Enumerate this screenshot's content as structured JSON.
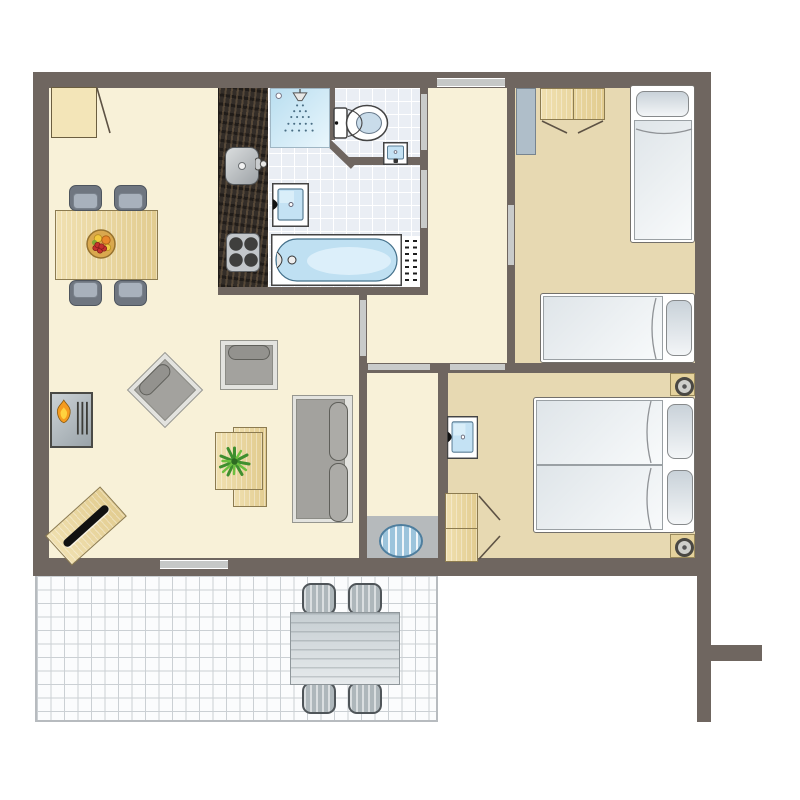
{
  "colors": {
    "wall": "#6F6660",
    "floorLiving": "#F8F1D8",
    "floorBedroom": "#E7D9B2",
    "floorBath": "#EAEEF4",
    "tileLine": "#FFFFFF",
    "floorTerrace": "#FBFCFD",
    "terraceLine": "#CBD0D4",
    "counter": "#332D28",
    "woodBorder": "#8C7B50",
    "doorBar": "#C9CBCA",
    "windowBar": "#C6C8C7",
    "grayA": "#A8B1BC",
    "grayB": "#6F7680",
    "sofaFrame": "#E3E3DF",
    "sofaSeat": "#A3A29E",
    "cushion": "#ACABA7",
    "fixtureBlue": "#C4E2F4",
    "flameOrange": "#F59B1E",
    "flameYellow": "#FFD23F",
    "plantGreen": "#3F8F2F",
    "matBlue": "#9CC4DC",
    "bedWhite": "#FFFFFF",
    "radiator": "#AFBEC9",
    "vestibule": "#B6BABC",
    "lampWood": "#E5D29C"
  },
  "shapes": [
    {
      "n": "living-room-floor",
      "c": "floor-living",
      "b": [
        49,
        88,
        646,
        472
      ]
    },
    {
      "n": "bedroom1-floor",
      "c": "floor-bed",
      "b": [
        515,
        88,
        180,
        277
      ]
    },
    {
      "n": "bedroom2-floor",
      "c": "floor-bed",
      "b": [
        448,
        373,
        247,
        187
      ]
    },
    {
      "n": "bathroom-floor",
      "c": "floor-bath",
      "b": [
        268,
        88,
        160,
        199
      ]
    },
    {
      "n": "kitchen-counter",
      "c": "counter",
      "b": [
        218,
        88,
        50,
        199
      ]
    },
    {
      "n": "vestibule-floor",
      "c": "vestibule",
      "b": [
        367,
        516,
        71,
        44
      ]
    },
    {
      "n": "terrace-floor",
      "c": "floor-terrace",
      "b": [
        35,
        574,
        403,
        148
      ]
    },
    {
      "n": "wall-top",
      "c": "wall",
      "b": [
        33,
        72,
        678,
        16
      ]
    },
    {
      "n": "wall-left",
      "c": "wall",
      "b": [
        33,
        72,
        16,
        504
      ]
    },
    {
      "n": "wall-right",
      "c": "wall",
      "b": [
        695,
        72,
        16,
        504
      ]
    },
    {
      "n": "wall-bottom",
      "c": "wall",
      "b": [
        33,
        558,
        678,
        18
      ]
    },
    {
      "n": "wall-right-extension",
      "c": "wall",
      "b": [
        697,
        576,
        14,
        146
      ]
    },
    {
      "n": "wall-garden-stub",
      "c": "wall",
      "b": [
        711,
        645,
        51,
        16
      ]
    },
    {
      "n": "wall-kitchenbath-south",
      "c": "wall",
      "b": [
        218,
        287,
        210,
        8
      ]
    },
    {
      "n": "wall-bathroom-east",
      "c": "wall",
      "b": [
        420,
        88,
        8,
        199
      ]
    },
    {
      "n": "wall-bedroom1-west",
      "c": "wall",
      "b": [
        507,
        88,
        8,
        277
      ]
    },
    {
      "n": "wall-middle",
      "c": "wall",
      "b": [
        359,
        363,
        352,
        10
      ]
    },
    {
      "n": "wall-living-hall",
      "c": "wall",
      "b": [
        359,
        294,
        8,
        69
      ]
    },
    {
      "n": "wall-corridor-west",
      "c": "wall",
      "b": [
        359,
        373,
        8,
        185
      ]
    },
    {
      "n": "wall-corridor-east",
      "c": "wall",
      "b": [
        438,
        373,
        10,
        185
      ]
    },
    {
      "n": "wall-toilet-west",
      "c": "wall",
      "b": [
        328,
        88,
        7,
        52
      ]
    },
    {
      "n": "wall-toilet-south",
      "c": "wall",
      "b": [
        348,
        157,
        72,
        8
      ]
    },
    {
      "n": "wall-toilet-diagonal",
      "c": "wall",
      "b": [
        327,
        136,
        40,
        7
      ],
      "r": 44,
      "o": "0 0"
    },
    {
      "n": "window-north",
      "c": "windowbar",
      "b": [
        437,
        78,
        68,
        9
      ]
    },
    {
      "n": "window-south",
      "c": "windowbar",
      "b": [
        160,
        560,
        68,
        9
      ]
    },
    {
      "n": "door-toilet",
      "c": "doorbar",
      "b": [
        421,
        94,
        6,
        56
      ]
    },
    {
      "n": "door-bathroom",
      "c": "doorbar",
      "b": [
        421,
        170,
        6,
        58
      ]
    },
    {
      "n": "door-bedroom1",
      "c": "doorbar",
      "b": [
        508,
        205,
        6,
        60
      ]
    },
    {
      "n": "door-corridor",
      "c": "doorbar",
      "b": [
        368,
        364,
        62,
        6
      ]
    },
    {
      "n": "door-bedroom2",
      "c": "doorbar",
      "b": [
        450,
        364,
        55,
        6
      ]
    },
    {
      "n": "door-living-hall",
      "c": "doorbar",
      "b": [
        360,
        300,
        6,
        56
      ]
    },
    {
      "n": "kitchen-sink",
      "c": "sink",
      "b": [
        225,
        147,
        34,
        38
      ]
    },
    {
      "n": "kitchen-faucet-icon",
      "c": "glyph",
      "b": [
        255,
        154,
        12,
        20
      ],
      "g": "kfaucet"
    },
    {
      "n": "kitchen-hob",
      "c": "hob",
      "b": [
        226,
        233,
        34,
        39
      ]
    },
    {
      "n": "shower",
      "c": "shower",
      "b": [
        270,
        88,
        60,
        60
      ],
      "g": "shower"
    },
    {
      "n": "toilet-icon",
      "c": "glyph",
      "b": [
        330,
        100,
        62,
        46
      ],
      "g": "toilet"
    },
    {
      "n": "hand-basin-icon",
      "c": "glyph",
      "b": [
        383,
        142,
        25,
        23
      ],
      "g": "handbasin"
    },
    {
      "n": "washbasin-icon",
      "c": "glyph",
      "b": [
        272,
        183,
        37,
        44
      ],
      "g": "basin"
    },
    {
      "n": "bathtub-icon",
      "c": "glyph",
      "b": [
        271,
        234,
        131,
        52
      ],
      "g": "tub"
    },
    {
      "n": "radiator-niche",
      "c": "white",
      "b": [
        402,
        236,
        18,
        51
      ]
    },
    {
      "n": "bathroom-radiator",
      "c": "radiator-v",
      "b": [
        404,
        240,
        15,
        45
      ]
    },
    {
      "n": "bedroom1-radiator",
      "c": "radiator-gray",
      "b": [
        516,
        88,
        20,
        67
      ]
    },
    {
      "n": "bedroom1-wardrobe",
      "c": "wood divider-v",
      "b": [
        540,
        88,
        65,
        32
      ]
    },
    {
      "n": "bedroom1-bed1-frame",
      "c": "bedframe",
      "b": [
        630,
        85,
        65,
        158
      ]
    },
    {
      "n": "bedroom1-bed1-mattress",
      "c": "mattress",
      "b": [
        634,
        120,
        58,
        120
      ]
    },
    {
      "n": "bedroom1-bed1-pillow",
      "c": "pillow",
      "b": [
        636,
        91,
        53,
        26
      ]
    },
    {
      "n": "bedroom1-bed2-frame",
      "c": "bedframe",
      "b": [
        540,
        293,
        155,
        70
      ]
    },
    {
      "n": "bedroom1-bed2-mattress",
      "c": "mattress",
      "b": [
        543,
        296,
        120,
        64
      ]
    },
    {
      "n": "bedroom1-bed2-pillow",
      "c": "pillow",
      "b": [
        666,
        300,
        26,
        56
      ]
    },
    {
      "n": "bedroom2-washbasin-icon",
      "c": "glyph",
      "b": [
        447,
        416,
        31,
        43
      ],
      "g": "basin"
    },
    {
      "n": "bedroom2-wardrobe",
      "c": "wood divider-h",
      "b": [
        445,
        493,
        33,
        69
      ]
    },
    {
      "n": "bedroom2-bed-frame",
      "c": "bedframe",
      "b": [
        533,
        397,
        162,
        136
      ]
    },
    {
      "n": "bedroom2-mattress-a",
      "c": "mattress",
      "b": [
        536,
        400,
        127,
        65
      ]
    },
    {
      "n": "bedroom2-mattress-b",
      "c": "mattress",
      "b": [
        536,
        465,
        127,
        65
      ]
    },
    {
      "n": "bedroom2-pillow-a",
      "c": "pillow",
      "b": [
        667,
        404,
        26,
        55
      ]
    },
    {
      "n": "bedroom2-pillow-b",
      "c": "pillow",
      "b": [
        667,
        470,
        26,
        55
      ]
    },
    {
      "n": "bedroom2-ceiling-spot-1",
      "c": "lamp",
      "b": [
        670,
        373,
        25,
        23
      ]
    },
    {
      "n": "bedroom2-ceiling-spot-2",
      "c": "lamp",
      "b": [
        670,
        534,
        25,
        24
      ]
    },
    {
      "n": "entry-door-leaf",
      "c": "doorleaf",
      "b": [
        51,
        87,
        46,
        51
      ]
    },
    {
      "n": "dining-table",
      "c": "wood",
      "b": [
        55,
        210,
        103,
        70
      ]
    },
    {
      "n": "dining-chair-1",
      "c": "chair chair-n",
      "b": [
        69,
        185,
        33,
        26
      ]
    },
    {
      "n": "dining-chair-2",
      "c": "chair chair-n",
      "b": [
        114,
        185,
        33,
        26
      ]
    },
    {
      "n": "dining-chair-3",
      "c": "chair chair-s",
      "b": [
        69,
        280,
        33,
        26
      ]
    },
    {
      "n": "dining-chair-4",
      "c": "chair chair-s",
      "b": [
        114,
        280,
        33,
        26
      ]
    },
    {
      "n": "fruit-bowl-icon",
      "c": "glyph",
      "b": [
        86,
        229,
        30,
        30
      ],
      "g": "fruit"
    },
    {
      "n": "fireplace",
      "c": "fireplace",
      "b": [
        50,
        392,
        43,
        56
      ],
      "g": "flame"
    },
    {
      "n": "armchair-1",
      "c": "armchair",
      "b": [
        138,
        363,
        54,
        54
      ],
      "r": -45
    },
    {
      "n": "armchair-2",
      "c": "armchair",
      "b": [
        220,
        340,
        58,
        50
      ]
    },
    {
      "n": "side-table-a",
      "c": "wood",
      "b": [
        233,
        427,
        34,
        80
      ]
    },
    {
      "n": "side-table-b",
      "c": "wood",
      "b": [
        215,
        432,
        48,
        58
      ]
    },
    {
      "n": "plant-icon",
      "c": "glyph",
      "b": [
        218,
        445,
        33,
        33
      ],
      "g": "plant"
    },
    {
      "n": "tv-table",
      "c": "wood tv",
      "b": [
        49,
        506,
        74,
        40
      ],
      "r": -42
    },
    {
      "n": "sofa-frame",
      "c": "sofa-frame",
      "b": [
        292,
        395,
        61,
        128
      ]
    },
    {
      "n": "sofa-seat",
      "c": "sofa-seat",
      "b": [
        296,
        399,
        49,
        120
      ]
    },
    {
      "n": "sofa-cushion-1",
      "c": "cushion",
      "b": [
        329,
        402,
        19,
        59
      ]
    },
    {
      "n": "sofa-cushion-2",
      "c": "cushion",
      "b": [
        329,
        463,
        19,
        59
      ]
    },
    {
      "n": "doormat",
      "c": "mat",
      "b": [
        379,
        524,
        44,
        34
      ]
    },
    {
      "n": "terrace-chair-1",
      "c": "outchair",
      "b": [
        302,
        583,
        34,
        32
      ]
    },
    {
      "n": "terrace-chair-2",
      "c": "outchair",
      "b": [
        348,
        583,
        34,
        32
      ]
    },
    {
      "n": "terrace-chair-3",
      "c": "outchair",
      "b": [
        302,
        682,
        34,
        32
      ]
    },
    {
      "n": "terrace-chair-4",
      "c": "outchair",
      "b": [
        348,
        682,
        34,
        32
      ]
    },
    {
      "n": "terrace-table",
      "c": "outtable",
      "b": [
        290,
        612,
        110,
        73
      ]
    },
    {
      "n": "plan-line-overlay",
      "c": "overlay",
      "b": [
        0,
        0,
        800,
        800
      ],
      "g": "overlay"
    }
  ]
}
